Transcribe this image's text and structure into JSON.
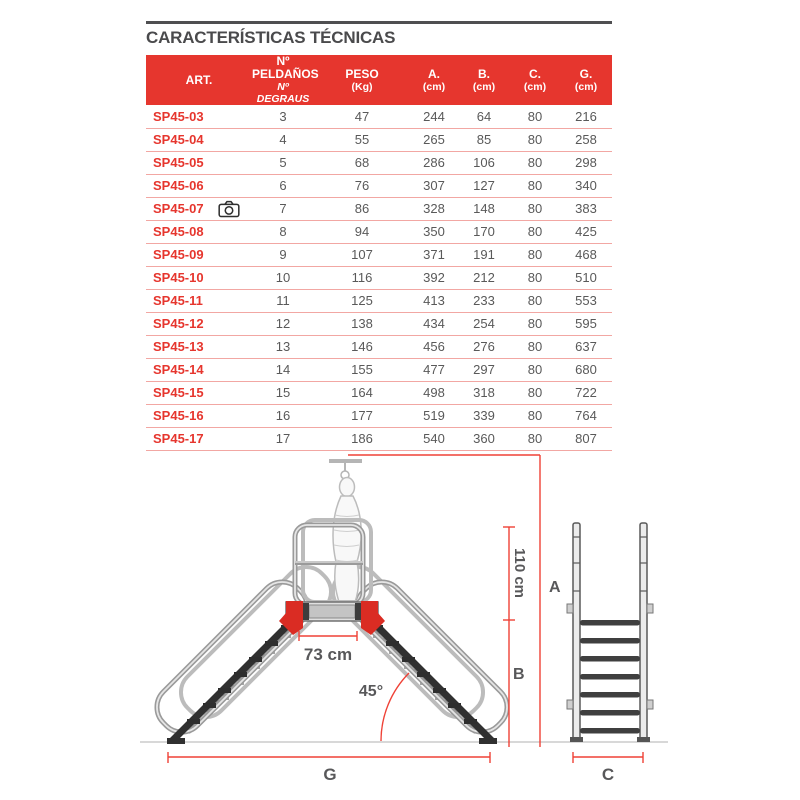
{
  "title": "CARACTERÍSTICAS TÉCNICAS",
  "table": {
    "columns": [
      {
        "key": "art",
        "label": "ART.",
        "sub": ""
      },
      {
        "key": "steps",
        "label": "Nº PELDAÑOS",
        "sub": "Nº DEGRAUS",
        "sub_italic": true
      },
      {
        "key": "peso",
        "label": "PESO",
        "sub": "(Kg)"
      },
      {
        "key": "a",
        "label": "A.",
        "sub": "(cm)"
      },
      {
        "key": "b",
        "label": "B.",
        "sub": "(cm)"
      },
      {
        "key": "c",
        "label": "C.",
        "sub": "(cm)"
      },
      {
        "key": "g",
        "label": "G.",
        "sub": "(cm)"
      }
    ],
    "rows": [
      {
        "art": "SP45-03",
        "camera": false,
        "steps": "3",
        "peso": "47",
        "a": "244",
        "b": "64",
        "c": "80",
        "g": "216"
      },
      {
        "art": "SP45-04",
        "camera": false,
        "steps": "4",
        "peso": "55",
        "a": "265",
        "b": "85",
        "c": "80",
        "g": "258"
      },
      {
        "art": "SP45-05",
        "camera": false,
        "steps": "5",
        "peso": "68",
        "a": "286",
        "b": "106",
        "c": "80",
        "g": "298"
      },
      {
        "art": "SP45-06",
        "camera": false,
        "steps": "6",
        "peso": "76",
        "a": "307",
        "b": "127",
        "c": "80",
        "g": "340"
      },
      {
        "art": "SP45-07",
        "camera": true,
        "steps": "7",
        "peso": "86",
        "a": "328",
        "b": "148",
        "c": "80",
        "g": "383"
      },
      {
        "art": "SP45-08",
        "camera": false,
        "steps": "8",
        "peso": "94",
        "a": "350",
        "b": "170",
        "c": "80",
        "g": "425"
      },
      {
        "art": "SP45-09",
        "camera": false,
        "steps": "9",
        "peso": "107",
        "a": "371",
        "b": "191",
        "c": "80",
        "g": "468"
      },
      {
        "art": "SP45-10",
        "camera": false,
        "steps": "10",
        "peso": "116",
        "a": "392",
        "b": "212",
        "c": "80",
        "g": "510"
      },
      {
        "art": "SP45-11",
        "camera": false,
        "steps": "11",
        "peso": "125",
        "a": "413",
        "b": "233",
        "c": "80",
        "g": "553"
      },
      {
        "art": "SP45-12",
        "camera": false,
        "steps": "12",
        "peso": "138",
        "a": "434",
        "b": "254",
        "c": "80",
        "g": "595"
      },
      {
        "art": "SP45-13",
        "camera": false,
        "steps": "13",
        "peso": "146",
        "a": "456",
        "b": "276",
        "c": "80",
        "g": "637"
      },
      {
        "art": "SP45-14",
        "camera": false,
        "steps": "14",
        "peso": "155",
        "a": "477",
        "b": "297",
        "c": "80",
        "g": "680"
      },
      {
        "art": "SP45-15",
        "camera": false,
        "steps": "15",
        "peso": "164",
        "a": "498",
        "b": "318",
        "c": "80",
        "g": "722"
      },
      {
        "art": "SP45-16",
        "camera": false,
        "steps": "16",
        "peso": "177",
        "a": "519",
        "b": "339",
        "c": "80",
        "g": "764"
      },
      {
        "art": "SP45-17",
        "camera": false,
        "steps": "17",
        "peso": "186",
        "a": "540",
        "b": "360",
        "c": "80",
        "g": "807"
      }
    ]
  },
  "icons": {
    "camera": "camera-icon"
  },
  "diagram": {
    "labels": {
      "rail_height": "110 cm",
      "platform_width": "73 cm",
      "angle": "45°",
      "dim_a": "A",
      "dim_b": "B",
      "dim_c": "C",
      "dim_g": "G"
    },
    "colors": {
      "accent_red": "#e6362e",
      "dimension_red": "#ef4136",
      "text_gray": "#58585a",
      "ground_gray": "#cbcbcb"
    }
  }
}
